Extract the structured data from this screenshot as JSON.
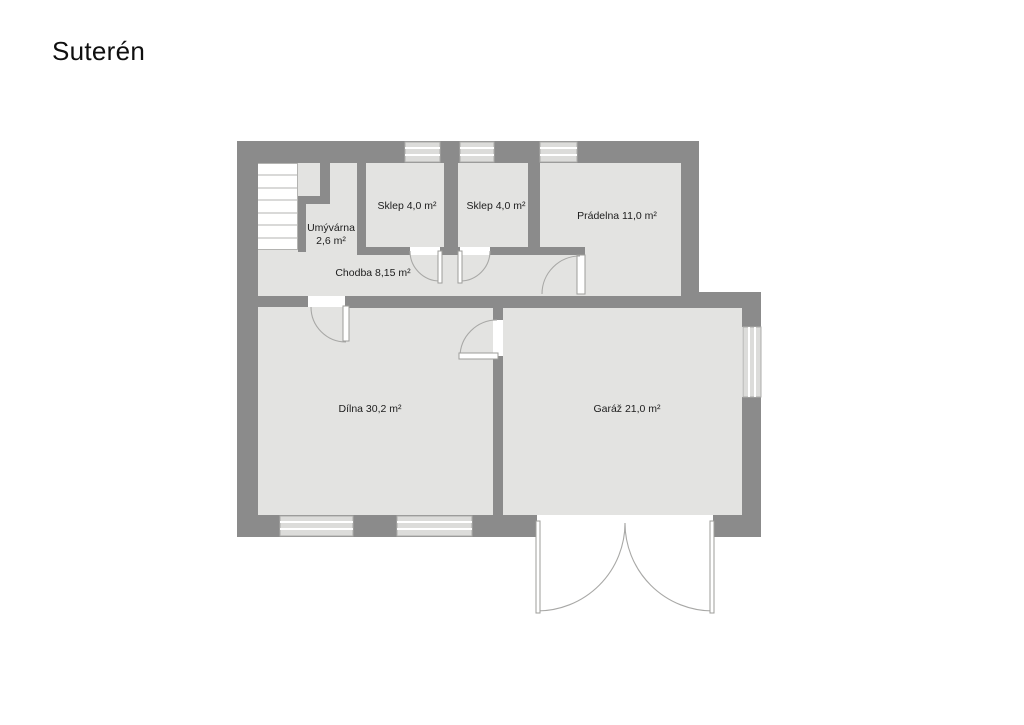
{
  "title": "Suterén",
  "plan": {
    "type": "floor-plan",
    "level": "basement",
    "rooms": [
      {
        "id": "umyvarna",
        "label": "Umývárna",
        "area": "2,6 m²"
      },
      {
        "id": "sklep-1",
        "label": "Sklep 4,0 m²"
      },
      {
        "id": "sklep-2",
        "label": "Sklep 4,0 m²"
      },
      {
        "id": "pradelna",
        "label": "Prádelna 11,0 m²"
      },
      {
        "id": "chodba",
        "label": "Chodba 8,15 m²"
      },
      {
        "id": "dilna",
        "label": "Dílna 30,2 m²"
      },
      {
        "id": "garaz",
        "label": "Garáž 21,0 m²"
      }
    ],
    "colors": {
      "wall": "#8b8b8b",
      "floor": "#e3e3e1",
      "window": "#dcdcda",
      "door_line": "#a8a8a6",
      "background": "#ffffff"
    },
    "features": {
      "windows_top": 3,
      "windows_bottom": 2,
      "windows_right": 1,
      "stairs": "top-left",
      "garage_door": "double swing, bottom"
    }
  }
}
